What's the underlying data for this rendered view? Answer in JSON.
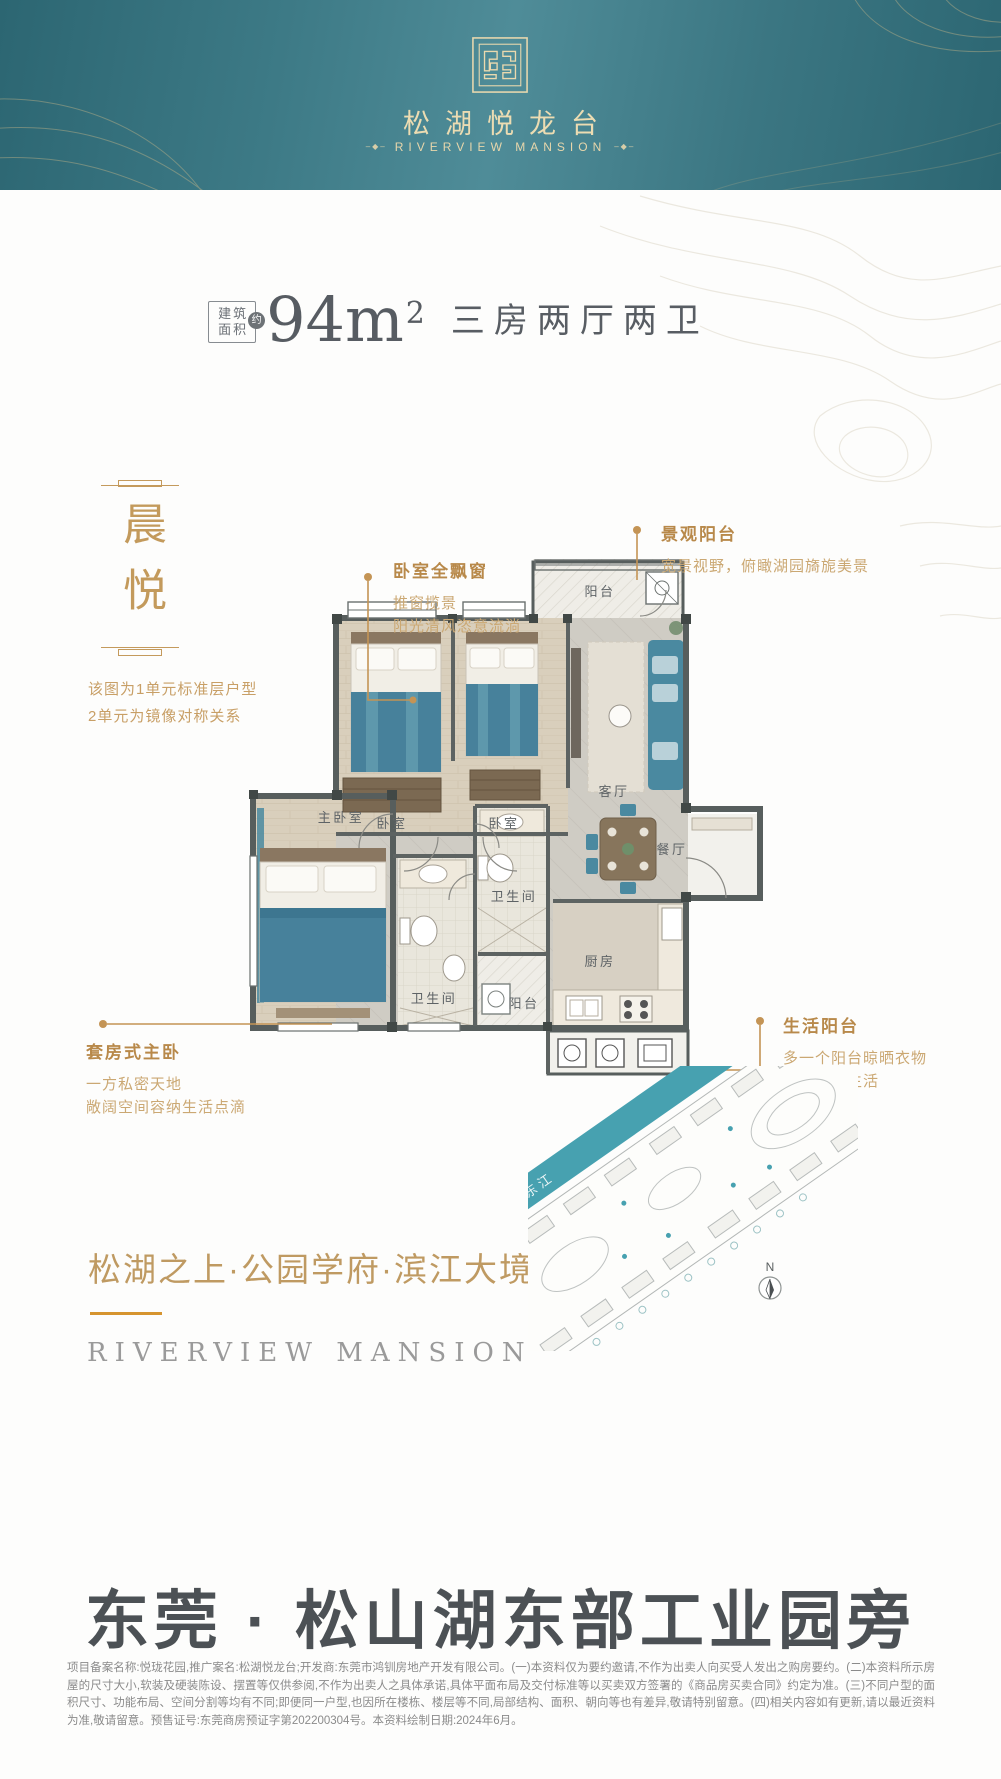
{
  "header": {
    "brand_cn": "松湖悦龙台",
    "brand_en": "RIVERVIEW MANSION",
    "ornament": "–◆–"
  },
  "spec": {
    "area_box_line1": "建筑",
    "area_box_line2": "面积",
    "area_approx_badge": "约",
    "area_value": "94m",
    "area_superscript": "2",
    "rooms_text": "三房两厅两卫"
  },
  "intro": {
    "vertical_title": "晨悦",
    "note_lines": [
      "该图为1单元标准层户型",
      "2单元为镜像对称关系"
    ]
  },
  "floorplan": {
    "rooms": {
      "balcony_top": "阳台",
      "bedroom_1": "卧室",
      "bedroom_2": "卧室",
      "living": "客厅",
      "dining": "餐厅",
      "master": "主卧室",
      "bath_1": "卫生间",
      "bath_2": "卫生间",
      "kitchen": "厨房",
      "balcony_bottom": "阳台"
    }
  },
  "callouts": {
    "window": {
      "title": "卧室全飘窗",
      "line1": "推窗揽景",
      "line2": "阳光清风恣意流淌"
    },
    "view_balcony": {
      "title": "景观阳台",
      "line1": "宽景视野，俯瞰湖园旖旎美景"
    },
    "master_suite": {
      "title": "套房式主卧",
      "line1": "一方私密天地",
      "line2": "敞阔空间容纳生活点滴"
    },
    "life_balcony": {
      "title": "生活阳台",
      "line1": "多一个阳台晾晒衣物",
      "line2": "安放幸福生活"
    }
  },
  "tagline": {
    "cn": "松湖之上·公园学府·滨江大境",
    "en": "RIVERVIEW  MANSION"
  },
  "sitemap": {
    "river_label": "东江",
    "compass_label": "N"
  },
  "footer": {
    "location_title": "东莞 · 松山湖东部工业园旁",
    "disclaimer": "项目备案名称:悦珑花园,推广案名:松湖悦龙台;开发商:东莞市鸿钏房地产开发有限公司。(一)本资料仅为要约邀请,不作为出卖人向买受人发出之购房要约。(二)本资料所示房屋的尺寸大小,软装及硬装陈设、摆置等仅供参阅,不作为出卖人之具体承诺,具体平面布局及交付标准等以买卖双方签署的《商品房买卖合同》约定为准。(三)不同户型的面积尺寸、功能布局、空间分割等均有不同;即便同一户型,也因所在楼栋、楼层等不同,局部结构、面积、朝向等也有差异,敬请特别留意。(四)相关内容如有更新,请以最近资料为准,敬请留意。预售证号:东莞商房预证字第202200304号。本资料绘制日期:2024年6月。"
  },
  "colors": {
    "accent_gold": "#c0904f",
    "header_teal": "#3d7a86",
    "title_gray": "#4c5155",
    "plan_teal": "#4a89a0"
  }
}
